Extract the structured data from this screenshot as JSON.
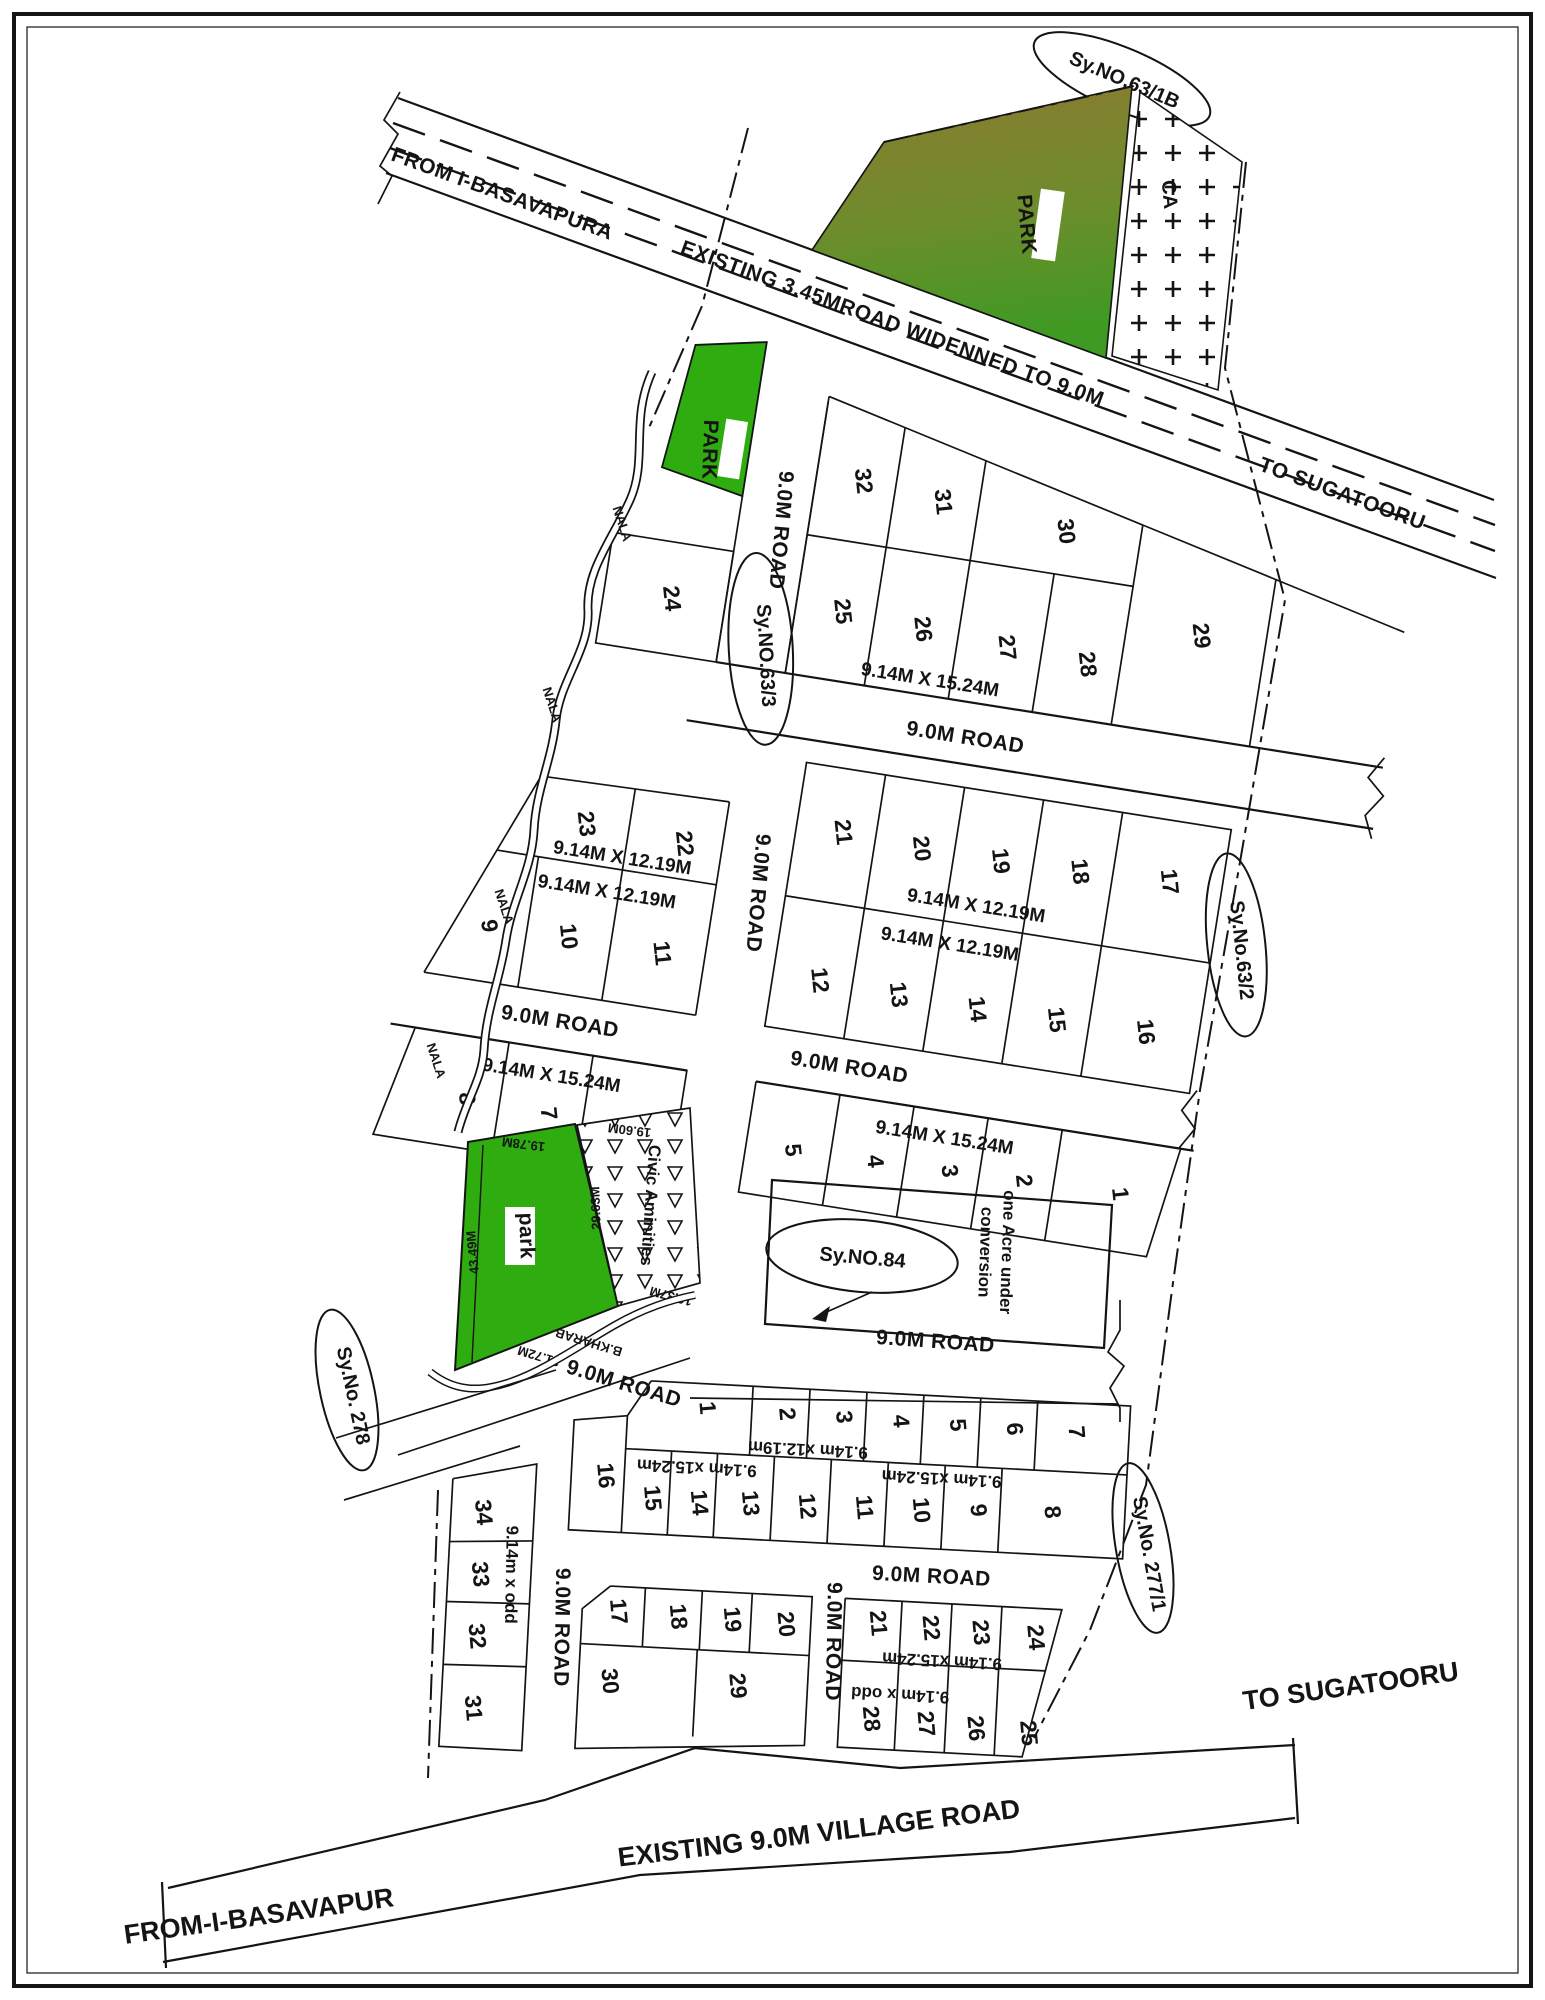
{
  "survey": {
    "sy63_1b": "Sy.NO.63/1B",
    "sy63_3": "Sy.NO.63/3",
    "sy63_2": "Sy.No.63/2",
    "sy84": "Sy.NO.84",
    "sy278": "Sy.No. 278",
    "sy277_1": "Sy.No. 277/1"
  },
  "roads": {
    "from_basavapura": "FROM I-BASAVAPURA",
    "widened": "EXISTING 3.45MROAD WIDENNED TO 9.0M",
    "to_sugatooru_top": "TO SUGATOORU",
    "r9": "9.0M ROAD",
    "village": "EXISTING 9.0M VILLAGE ROAD",
    "from_basavapur": "FROM-I-BASAVAPUR",
    "to_sugatooru_bottom": "TO SUGATOORU"
  },
  "features": {
    "park_upper": "PARK",
    "park_small": "PARK",
    "park_lower": "park",
    "ca": "CA",
    "civic": "Civic Aminities",
    "acre_line1": "one Acre under",
    "acre_line2": "conversion",
    "kharab": "B.KHARAB",
    "nala": "NALA"
  },
  "dims": {
    "plot_15": "9.14M X 15.24M",
    "plot_12": "9.14M X 12.19M",
    "plot_12_lc": "9.14m x12.19m",
    "plot_15_lc": "9.14m x15.24m",
    "plot_odd": "9.14m x odd",
    "park_top": "19.78M",
    "park_left": "43.49M",
    "park_bottom": "31.72M",
    "civic_top": "19.60M",
    "civic_left": "29.63M",
    "civic_bottom": "16.37M"
  },
  "plots": {
    "row_a": [
      "32",
      "31",
      "30",
      "29"
    ],
    "row_b": [
      "25",
      "26",
      "27",
      "28"
    ],
    "p24": "24",
    "left_top": [
      "23",
      "22"
    ],
    "left_bottom": [
      "9",
      "10",
      "11"
    ],
    "row_c": [
      "21",
      "20",
      "19",
      "18",
      "17"
    ],
    "row_d": [
      "12",
      "13",
      "14",
      "15",
      "16"
    ],
    "row_e": [
      "8",
      "7",
      "6"
    ],
    "row_f": [
      "5",
      "4",
      "3",
      "2",
      "1"
    ],
    "b_row1": [
      "1",
      "2",
      "3",
      "4",
      "5",
      "6",
      "7"
    ],
    "b_row2": [
      "16",
      "15",
      "14",
      "13",
      "12",
      "11",
      "10",
      "9",
      "8"
    ],
    "b_row3_left": [
      "17",
      "18",
      "19",
      "20"
    ],
    "b_row3_right": [
      "21",
      "22",
      "23",
      "24"
    ],
    "b_row4_left": [
      "30",
      "29"
    ],
    "b_row4_right": [
      "28",
      "27",
      "26",
      "25"
    ],
    "strip": [
      "34",
      "33",
      "32",
      "31"
    ]
  },
  "colors": {
    "park_green": "#2EAC10",
    "park_grad_top": "#8C7A31",
    "park_grad_mid": "#6D8D2C",
    "park_grad_bottom": "#3E9A22",
    "ink": "#141414"
  }
}
